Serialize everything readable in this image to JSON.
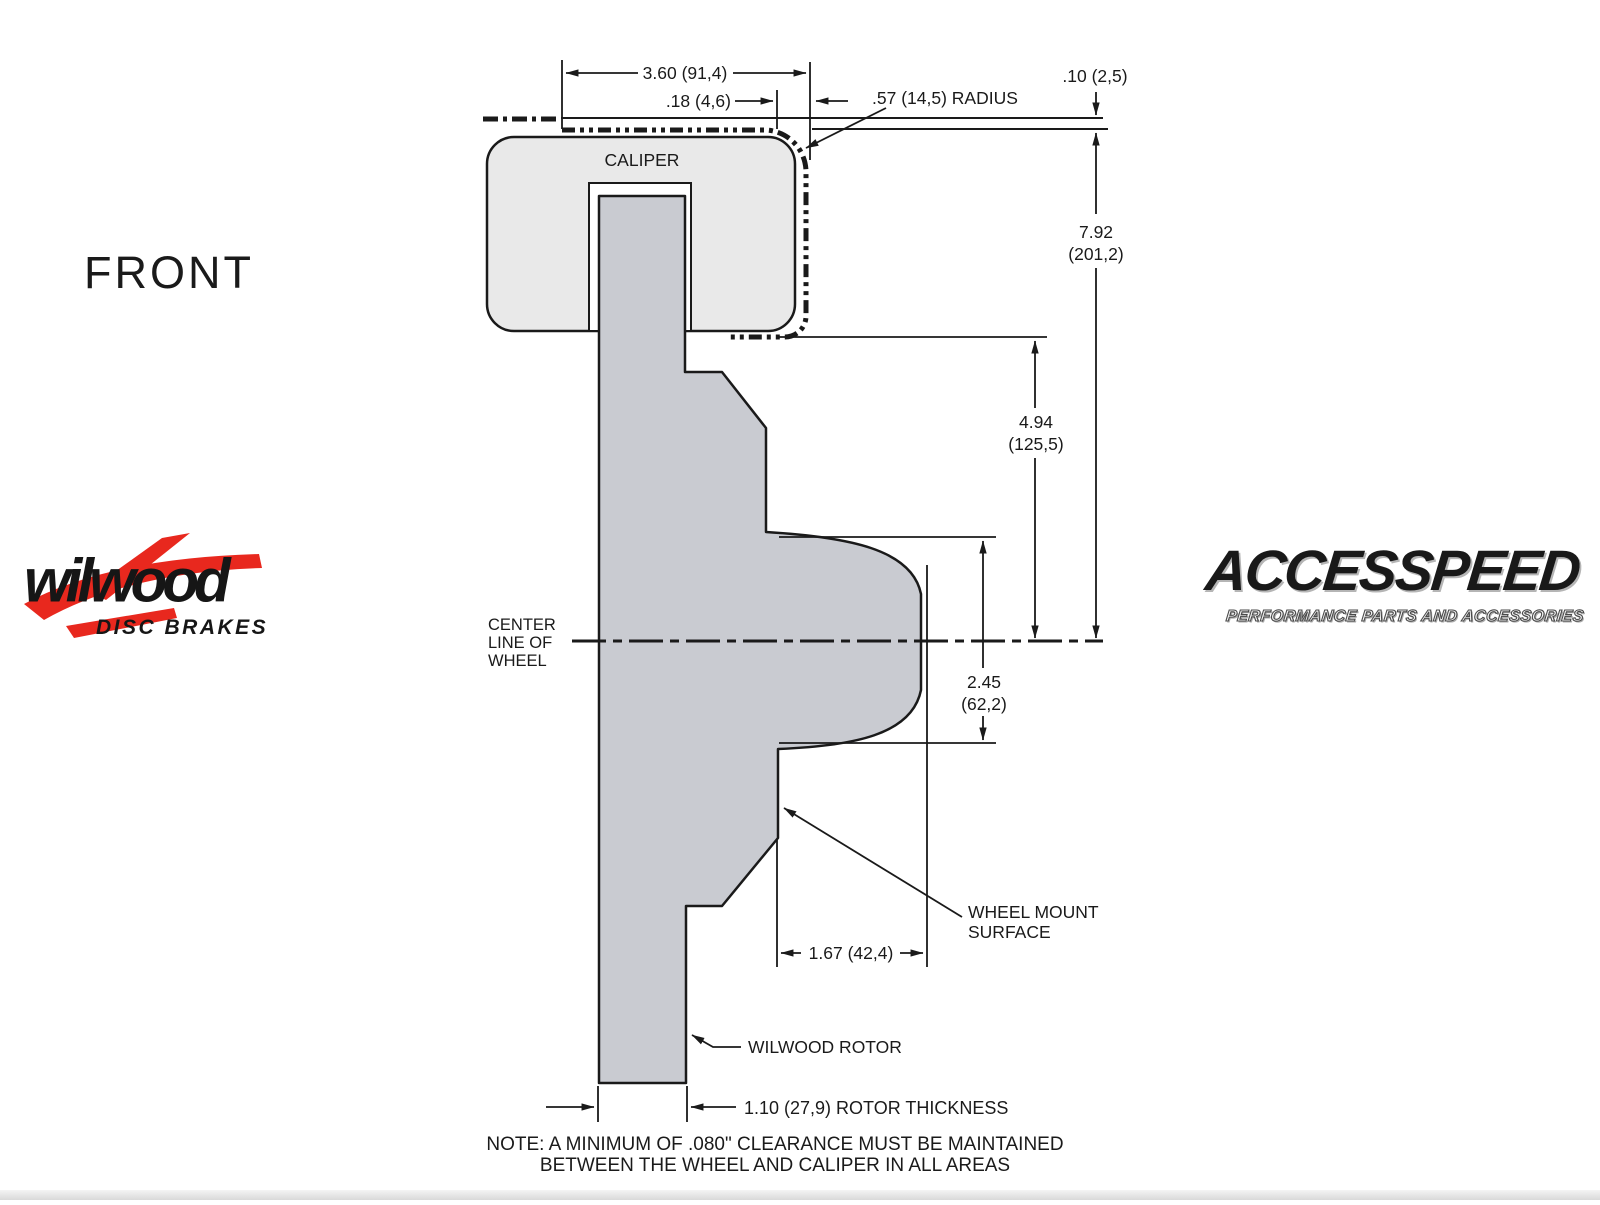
{
  "drawing": {
    "view_label": "FRONT",
    "caliper_label": "CALIPER",
    "centerline": [
      "CENTER",
      "LINE OF",
      "WHEEL"
    ],
    "dims": {
      "caliper_width": "3.60 (91,4)",
      "caliper_offset": ".18 (4,6)",
      "corner_radius": ".57 (14,5) RADIUS",
      "wheel_clearance": ".10 (2,5)",
      "wheel_radius_in": "7.92",
      "wheel_radius_mm": "(201,2)",
      "caliper_to_center_in": "4.94",
      "caliper_to_center_mm": "(125,5)",
      "hat_depth_in": "2.45",
      "hat_depth_mm": "(62,2)",
      "mount_offset": "1.67 (42,4)",
      "rotor_thickness": "1.10 (27,9) ROTOR THICKNESS"
    },
    "callouts": {
      "wheel_mount_1": "WHEEL MOUNT",
      "wheel_mount_2": "SURFACE",
      "rotor": "WILWOOD ROTOR"
    },
    "note": [
      "NOTE: A MINIMUM OF .080\" CLEARANCE MUST BE MAINTAINED",
      "BETWEEN THE WHEEL AND CALIPER IN ALL AREAS"
    ]
  },
  "logos": {
    "wilwood": {
      "name": "wilwood",
      "tagline": "DISC BRAKES"
    },
    "accesspeed": {
      "name": "ACCESSPEED",
      "tagline": "PERFORMANCE PARTS AND ACCESSORIES"
    }
  },
  "colors": {
    "line": "#1a1a1a",
    "caliper_fill": "#e9e9e9",
    "rotor_fill": "#c9cbd1",
    "logo_red": "#e8281e"
  }
}
